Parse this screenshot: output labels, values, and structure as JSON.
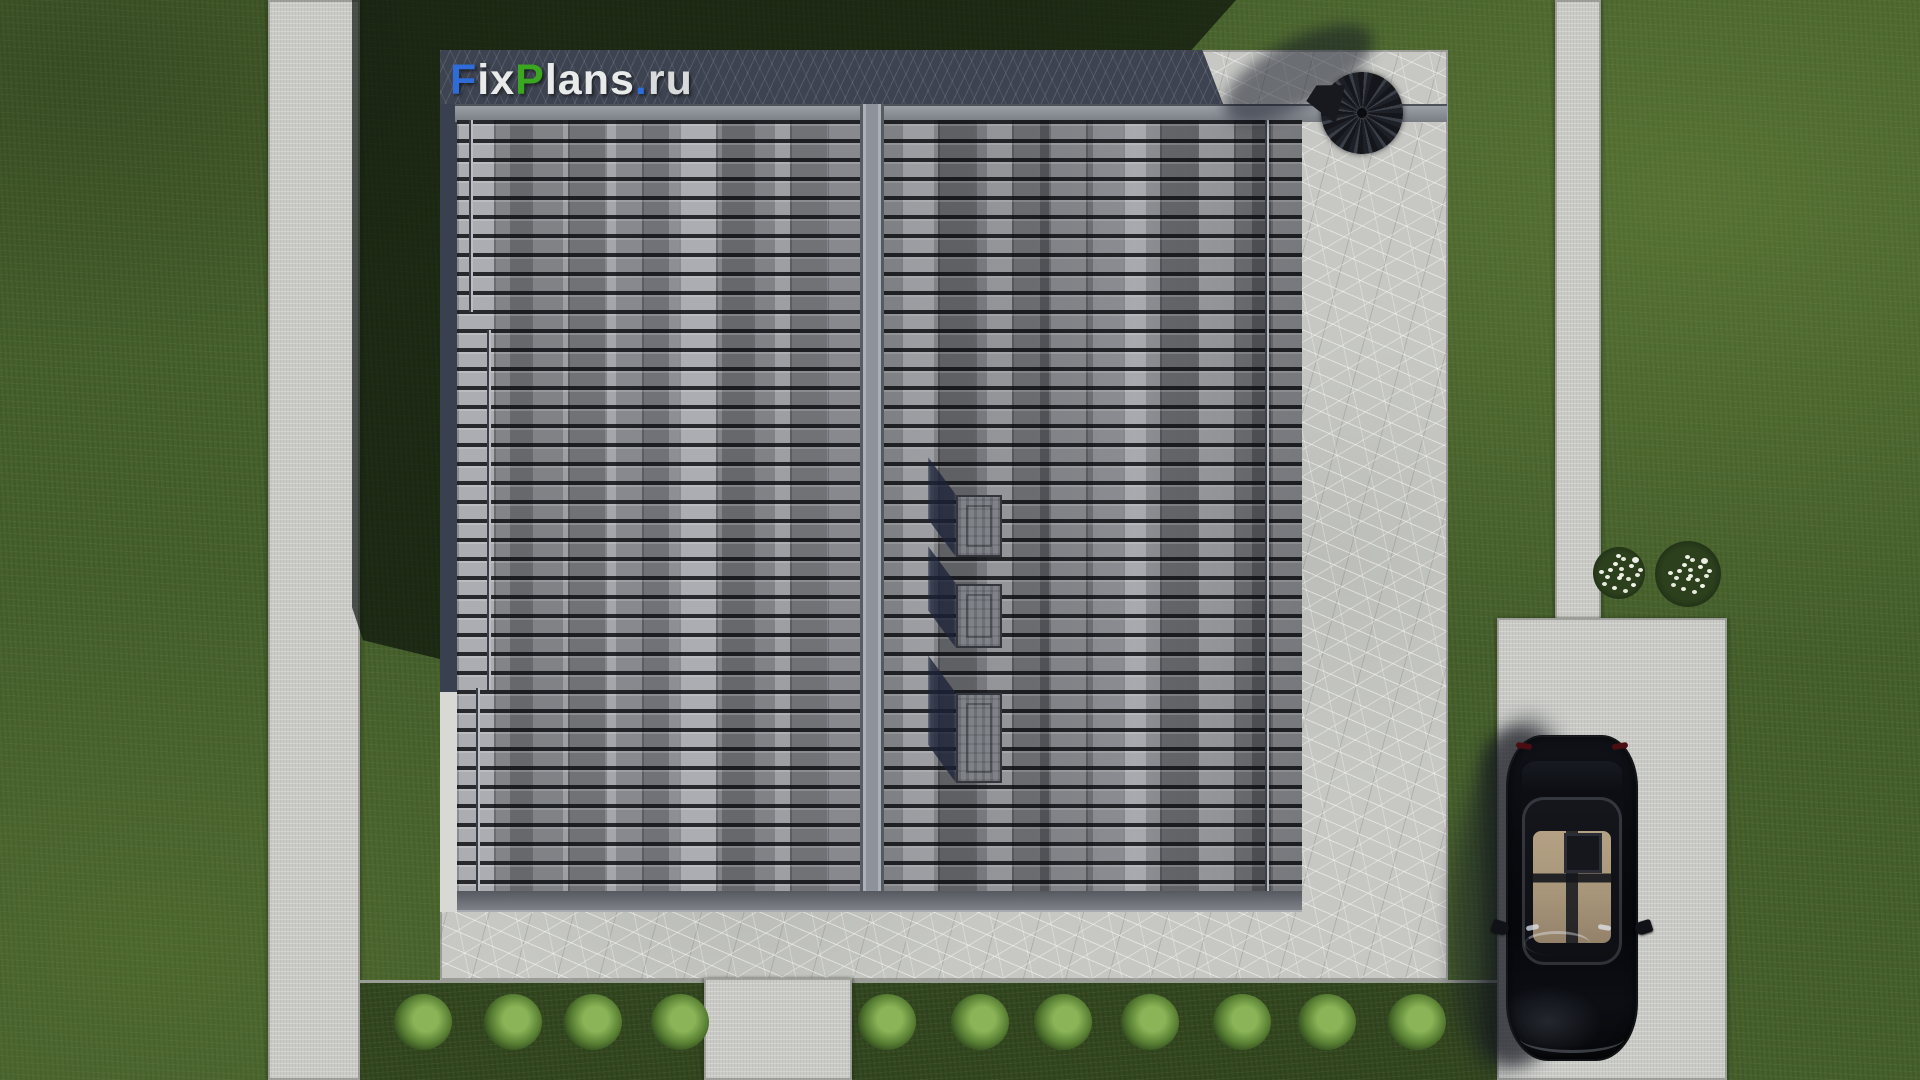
{
  "scene": {
    "kind": "aerial 3D architectural render - top view of a house roof with terrace, paths, driveway, car and garden",
    "watermark": "FixPlans.ru"
  },
  "logo": {
    "text": "FixPlans.ru",
    "segments": [
      {
        "text": "F",
        "css": "color:#2f6cd8"
      },
      {
        "text": "ix",
        "css": "color:#e9eaea"
      },
      {
        "text": "P",
        "css": "color:#3ba61f"
      },
      {
        "text": "lans",
        "css": "color:#e9eaea"
      },
      {
        "text": ".",
        "css": "color:#2f6cd8"
      },
      {
        "text": "ru",
        "css": "color:#d9dadb"
      }
    ]
  },
  "palette": {
    "grass": "#46602c",
    "grass_shadow": "#18220f",
    "concrete_path": "#cacbc7",
    "terrace_pavement": "#c7c8c4",
    "pavement_in_shadow": "#3d4350",
    "roof_tile": "#8b8d93",
    "roof_fascia": "#6a6d73",
    "ridge_cap": "#9aa0a8",
    "roof_vent_shadow": "#1c2238",
    "car_body": "#0a0c10",
    "car_interior": "#a8967a",
    "hedge_bush": "#587f33",
    "flower_white": "#eef0e6",
    "umbrella": "#1a1d23"
  },
  "objects": {
    "roof_vents": 3,
    "hedge_bushes": 11,
    "flower_bushes": 2,
    "car": "black sedan parked on driveway, viewed from above",
    "umbrella": "dark patio umbrella at top-right corner of terrace"
  }
}
